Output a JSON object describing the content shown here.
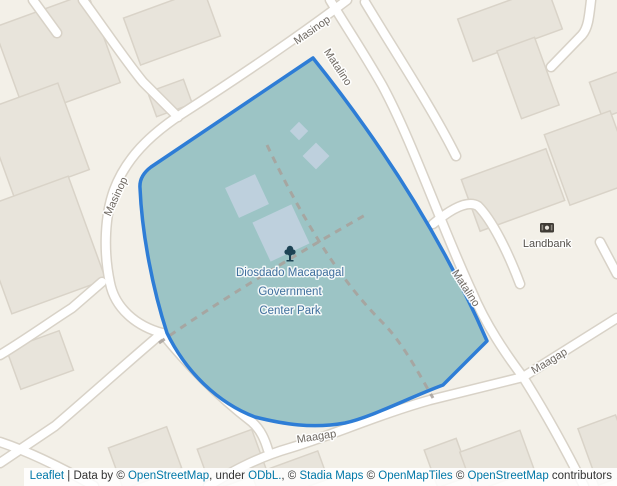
{
  "colors": {
    "background": "#f3f0e8",
    "building_fill": "#e8e4db",
    "building_outline": "#d9d3c8",
    "road_fill": "#ffffff",
    "road_casing": "#d8d2c7",
    "park_fill": "#9cc4c5",
    "park_border": "#2e7dd6",
    "park_building_fill": "#c1d2e0",
    "footpath_dash": "#a8a19b",
    "street_label": "#6e6861",
    "poi_label": "#54504b",
    "park_label": "#3f6f9d",
    "attribution_text": "#333333",
    "attribution_link": "#0078a8"
  },
  "streets": {
    "masinop_top": "Masinop",
    "masinop_left": "Masinop",
    "matalino_top": "Matalino",
    "matalino_right": "Matalino",
    "maagap_bottom": "Maagap",
    "maagap_right": "Maagap"
  },
  "park": {
    "name_line1": "Diosdado Macapagal",
    "name_line2": "Government",
    "name_line3": "Center Park",
    "icon": "tree-icon"
  },
  "poi": {
    "landbank_label": "Landbank",
    "landbank_icon": "bank-icon"
  },
  "attribution": {
    "segments": [
      {
        "text": "Leaflet",
        "link": true
      },
      {
        "text": " | Data by © ",
        "link": false
      },
      {
        "text": "OpenStreetMap",
        "link": true
      },
      {
        "text": ", under ",
        "link": false
      },
      {
        "text": "ODbL.",
        "link": true
      },
      {
        "text": ", © ",
        "link": false
      },
      {
        "text": "Stadia Maps",
        "link": true
      },
      {
        "text": " © ",
        "link": false
      },
      {
        "text": "OpenMapTiles",
        "link": true
      },
      {
        "text": " © ",
        "link": false
      },
      {
        "text": "OpenStreetMap",
        "link": true
      },
      {
        "text": " contributors",
        "link": false
      }
    ]
  }
}
